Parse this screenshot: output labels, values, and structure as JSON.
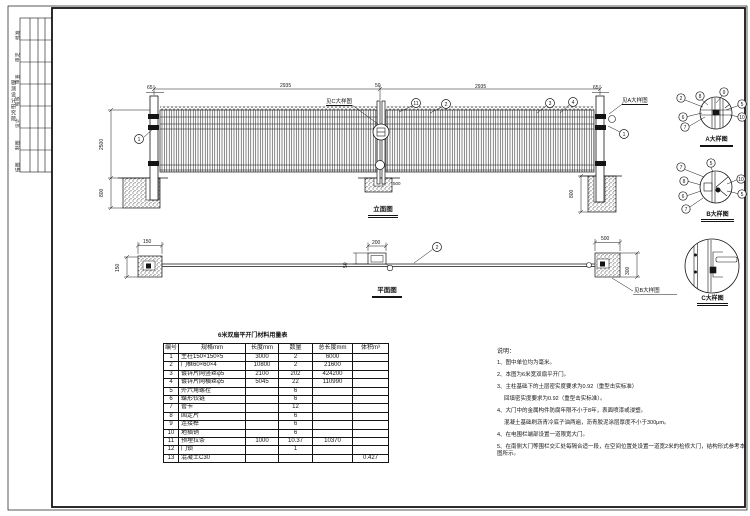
{
  "sheet": {
    "bg": "#ffffff",
    "ink": "#141414"
  },
  "titleblock": {
    "org": "勘测设计研究院",
    "rows": [
      "批准",
      "审定",
      "审查",
      "校核",
      "设计",
      "制图",
      "描图"
    ]
  },
  "elevation": {
    "title": "立面图",
    "dim_top_left": "2935",
    "dim_top_right": "2935",
    "dim_gap": "50",
    "dim_post_l": "65",
    "dim_post_r": "65",
    "dim_height": "2500",
    "dim_found": "800",
    "dim_found_r": "800",
    "dim_center_found": "500",
    "see_c": "见C大样图",
    "see_a": "见A大样图",
    "callouts": {
      "c1l": "1",
      "c11": "11",
      "c2": "2",
      "c3": "3",
      "c4": "4",
      "c1r": "1"
    }
  },
  "plan": {
    "title": "平面图",
    "dim_post_l_w": "150",
    "dim_post_l_d": "150",
    "dim_lock_w": "200",
    "dim_lock_d": "50",
    "dim_post_r_w": "500",
    "dim_post_r_d": "300",
    "see_b": "见B大样图",
    "callout2": "2"
  },
  "details": {
    "a": {
      "label": "A大样图",
      "callouts": [
        "2",
        "8",
        "9",
        "5",
        "10",
        "6",
        "7"
      ]
    },
    "b": {
      "label": "B大样图",
      "callouts": [
        "7",
        "5",
        "10",
        "8",
        "6",
        "7",
        "5"
      ]
    },
    "c": {
      "label": "C大样图"
    }
  },
  "table": {
    "title": "6米双扇平开门材料用量表",
    "headers": [
      "编号",
      "规格mm",
      "长度mm",
      "数量",
      "总长度mm",
      "体积m³"
    ],
    "rows": [
      [
        "1",
        "主柱150×150×5",
        "3000",
        "2",
        "6000",
        ""
      ],
      [
        "2",
        "门框60×60×4",
        "10800",
        "2",
        "21600",
        ""
      ],
      [
        "3",
        "镀锌片网竖丝φ5",
        "2100",
        "202",
        "424200",
        ""
      ],
      [
        "4",
        "镀锌片网横丝φ5",
        "5045",
        "22",
        "110990",
        ""
      ],
      [
        "5",
        "外六角螺栓",
        "",
        "6",
        "",
        ""
      ],
      [
        "6",
        "蝶形铰链",
        "",
        "6",
        "",
        ""
      ],
      [
        "7",
        "管卡",
        "",
        "12",
        "",
        ""
      ],
      [
        "8",
        "固定片",
        "",
        "6",
        "",
        ""
      ],
      [
        "9",
        "连接榫",
        "",
        "6",
        "",
        ""
      ],
      [
        "10",
        "地插销",
        "",
        "6",
        "",
        ""
      ],
      [
        "11",
        "预埋拉条",
        "1000",
        "10.37",
        "10370",
        ""
      ],
      [
        "12",
        "门锁",
        "",
        "1",
        "",
        ""
      ],
      [
        "13",
        "混凝土C30",
        "",
        "",
        "",
        "0.427"
      ]
    ]
  },
  "notes": {
    "title": "说明：",
    "items": [
      {
        "t": "1、图中单位均为毫米。",
        "i": 0
      },
      {
        "t": "2、本图为6米宽双扇平开门。",
        "i": 0
      },
      {
        "t": "3、主柱基础下的土层密实度要求为0.92（重型击实标准）",
        "i": 0
      },
      {
        "t": "回填密实度要求为0.92（重型击实标准）。",
        "i": 1
      },
      {
        "t": "4、大门中的金属构件防腐年限不小于8年，表面喷漆或浸塑。",
        "i": 0
      },
      {
        "t": "混凝土基础刷沥青冷底子油两遍，沥青胶泥涂层厚度不小于300μm。",
        "i": 1
      },
      {
        "t": "4、在电围栏端部设置一道限宽大门。",
        "i": 0
      },
      {
        "t": "5、在南侧大门等围栏交汇处每隔合适一段，在空间位置处设置一道宽2米的检修大门，结构形式参考本图所示。",
        "i": 0
      }
    ]
  }
}
